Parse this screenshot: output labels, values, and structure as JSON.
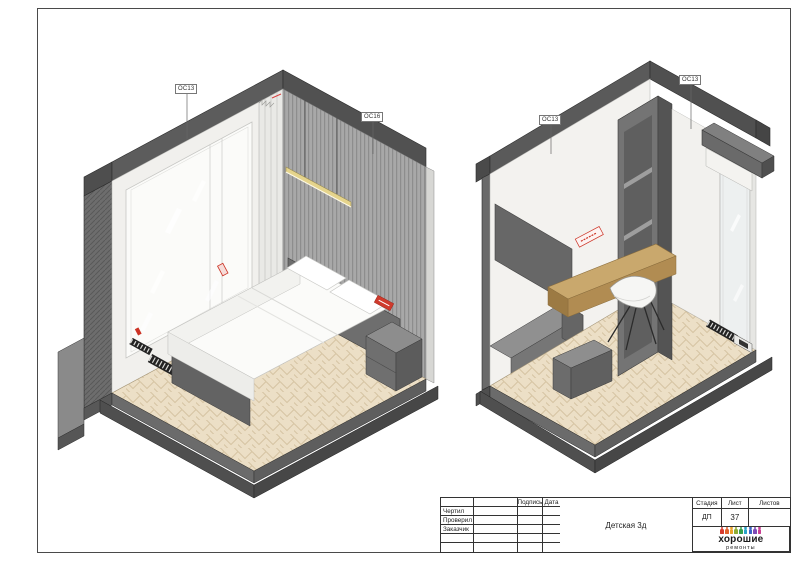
{
  "sheet": {
    "background": "#ffffff",
    "frame_color": "#4a4a4a"
  },
  "views": {
    "left": {
      "description": "axonometric view of children's bedroom with bed",
      "labels": {
        "window": "ОС13",
        "wall": "ОС16"
      }
    },
    "right": {
      "description": "axonometric view of children's bedroom with desk",
      "labels": {
        "left_wall": "ОС13",
        "window": "ОС13"
      }
    }
  },
  "title_block": {
    "columns": {
      "signature": "Подпись",
      "date": "Дата"
    },
    "roles": {
      "drew": "Чертил",
      "checked": "Проверил",
      "client": "Заказчик"
    },
    "document_title": "Детская 3д",
    "stage": {
      "header": "Стадия",
      "value": "ДП"
    },
    "sheet": {
      "header": "Лист",
      "value": "37"
    },
    "sheets": {
      "header": "Листов",
      "value": ""
    },
    "logo": {
      "title": "хорошие",
      "subtitle": "ремонты",
      "people_colors": [
        "#d63b2f",
        "#e1622c",
        "#eda32b",
        "#8fae35",
        "#33a04c",
        "#2aa3c9",
        "#3b63c4",
        "#7d4bb5",
        "#c93f93"
      ]
    }
  },
  "colors": {
    "accent_red": "#cc3325",
    "wood": "#c9a86d",
    "slat_wall_gray": "#a8a8a8",
    "section_dark_gray": "#585858",
    "floor_beige": "#ecdfc6",
    "pendant_yellow": "#e5d48c"
  }
}
